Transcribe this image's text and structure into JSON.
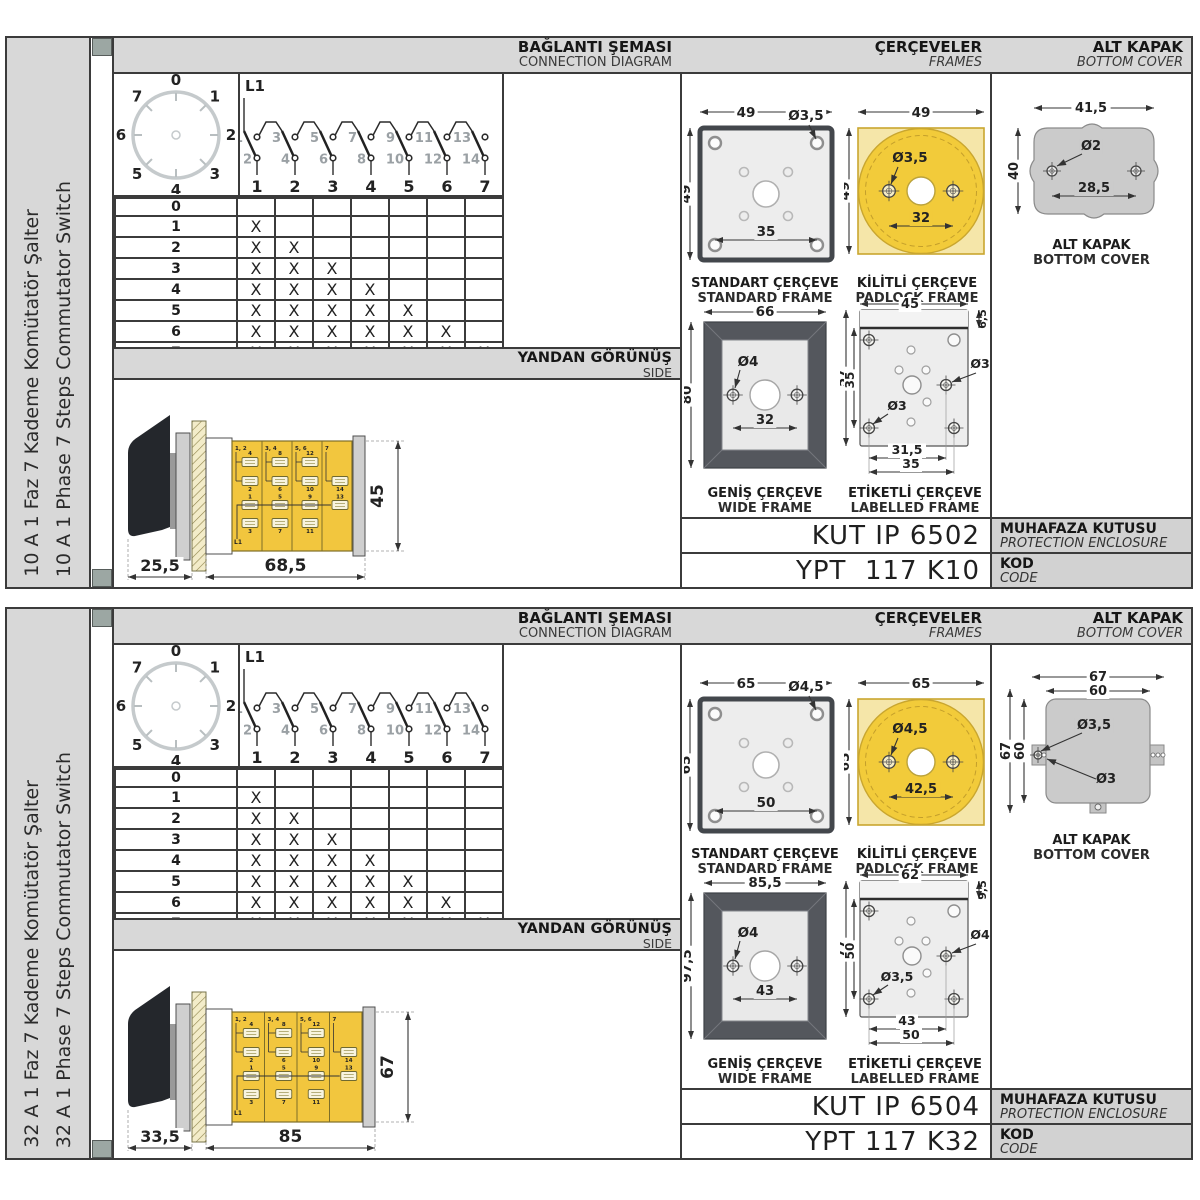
{
  "colors": {
    "border": "#3b3b3b",
    "bar_gray": "#d8d8d8",
    "label_gray": "#d2d2d2",
    "corner_mark": "#9CA7A3",
    "body_yellow": "#F2C63E",
    "padlock_gold": "#F2CB3A",
    "padlock_pale": "#F5E6A9",
    "wide_frame_dark": "#54575D",
    "plate_gray": "#cfcfcf",
    "cover_gray": "#cbcbcb"
  },
  "shared": {
    "dial_labels": [
      "0",
      "1",
      "2",
      "3",
      "4",
      "5",
      "6",
      "7"
    ],
    "l1": {
      "feed": "L1",
      "top": [
        "1",
        "3",
        "5",
        "7",
        "9",
        "11",
        "13"
      ],
      "bottom": [
        "2",
        "4",
        "6",
        "8",
        "10",
        "12",
        "14"
      ],
      "columns": [
        "1",
        "2",
        "3",
        "4",
        "5",
        "6",
        "7"
      ]
    },
    "table": {
      "rows": [
        "0",
        "1",
        "2",
        "3",
        "4",
        "5",
        "6",
        "7"
      ],
      "mark": "X",
      "marks": [
        0,
        1,
        2,
        3,
        4,
        5,
        6,
        7
      ]
    },
    "sideview_labels": {
      "feed": "L1",
      "seg_tops": [
        "1, 2",
        "3, 4",
        "5, 6",
        "7"
      ],
      "upper": [
        [
          "4",
          "2"
        ],
        [
          "8",
          "6"
        ],
        [
          "12",
          "10"
        ],
        [
          "14"
        ]
      ],
      "lower": [
        [
          "1",
          "3"
        ],
        [
          "5",
          "7"
        ],
        [
          "9",
          "11"
        ],
        [
          "13"
        ]
      ]
    }
  },
  "panels": [
    {
      "sidebar_tr": "10 A 1 Faz 7 Kademe Komütatör Şalter",
      "sidebar_en": "10 A 1 Phase 7 Steps Commutator Switch",
      "headers": {
        "connection_tr": "BAĞLANTI ŞEMASI",
        "connection_en": "CONNECTION DIAGRAM",
        "frames_tr": "ÇERÇEVELER",
        "frames_en": "FRAMES",
        "cover_tr": "ALT KAPAK",
        "cover_en": "BOTTOM COVER",
        "side_tr": "YANDAN GÖRÜNÜŞ",
        "side_en": "SIDE"
      },
      "dims": {
        "handle": "25,5",
        "body": "68,5",
        "height": "45"
      },
      "frames": {
        "standard": {
          "caption_tr": "STANDART ÇERÇEVE",
          "caption_en": "STANDARD FRAME",
          "width": "49",
          "height": "49",
          "hole": "Ø3,5",
          "pitch": "35"
        },
        "padlock": {
          "caption_tr": "KİLİTLİ ÇERÇEVE",
          "caption_en": "PADLOCK FRAME",
          "width": "49",
          "height": "49",
          "hole": "Ø3,5",
          "pitch": "32"
        },
        "wide": {
          "caption_tr": "GENİŞ ÇERÇEVE",
          "caption_en": "WIDE FRAME",
          "width": "66",
          "height": "80",
          "hole": "Ø4",
          "pitch": "32"
        },
        "labelled": {
          "caption_tr": "ETİKETLİ ÇERÇEVE",
          "caption_en": "LABELLED FRAME",
          "width": "45",
          "strip": "6,5",
          "height": "57",
          "inner": "35",
          "hole_right": "Ø3",
          "hole_left": "Ø3",
          "pitch1": "31,5",
          "pitch2": "35"
        }
      },
      "cover": {
        "type": "blob",
        "caption_tr": "ALT KAPAK",
        "caption_en": "BOTTOM COVER",
        "width": "41,5",
        "height": "40",
        "hole": "Ø2",
        "pitch": "28,5"
      },
      "codes": {
        "enclosure": "KUT IP 6502",
        "enclosure_label_tr": "MUHAFAZA KUTUSU",
        "enclosure_label_en": "PROTECTION ENCLOSURE",
        "code": "YPT  117 K10",
        "code_label_tr": "KOD",
        "code_label_en": "CODE"
      }
    },
    {
      "sidebar_tr": "32 A 1 Faz 7 Kademe Komütatör Şalter",
      "sidebar_en": "32 A 1 Phase 7 Steps Commutator Switch",
      "headers": {
        "connection_tr": "BAĞLANTI ŞEMASI",
        "connection_en": "CONNECTION DIAGRAM",
        "frames_tr": "ÇERÇEVELER",
        "frames_en": "FRAMES",
        "cover_tr": "ALT KAPAK",
        "cover_en": "BOTTOM COVER",
        "side_tr": "YANDAN GÖRÜNÜŞ",
        "side_en": "SIDE"
      },
      "dims": {
        "handle": "33,5",
        "body": "85",
        "height": "67"
      },
      "frames": {
        "standard": {
          "caption_tr": "STANDART ÇERÇEVE",
          "caption_en": "STANDARD FRAME",
          "width": "65",
          "height": "65",
          "hole": "Ø4,5",
          "pitch": "50"
        },
        "padlock": {
          "caption_tr": "KİLİTLİ ÇERÇEVE",
          "caption_en": "PADLOCK FRAME",
          "width": "65",
          "height": "65",
          "hole": "Ø4,5",
          "pitch": "42,5"
        },
        "wide": {
          "caption_tr": "GENİŞ ÇERÇEVE",
          "caption_en": "WIDE FRAME",
          "width": "85,5",
          "height": "97,5",
          "hole": "Ø4",
          "pitch": "43"
        },
        "labelled": {
          "caption_tr": "ETİKETLİ ÇERÇEVE",
          "caption_en": "LABELLED FRAME",
          "width": "62",
          "strip": "9,5",
          "height": "77",
          "inner": "50",
          "hole_right": "Ø4",
          "hole_left": "Ø3,5",
          "pitch1": "43",
          "pitch2": "50"
        }
      },
      "cover": {
        "type": "tabs",
        "caption_tr": "ALT KAPAK",
        "caption_en": "BOTTOM COVER",
        "w_outer": "67",
        "w_inner": "60",
        "h_outer": "67",
        "h_inner": "60",
        "hole_big": "Ø3,5",
        "hole_small": "Ø3"
      },
      "codes": {
        "enclosure": "KUT IP 6504",
        "enclosure_label_tr": "MUHAFAZA KUTUSU",
        "enclosure_label_en": "PROTECTION ENCLOSURE",
        "code": "YPT 117 K32",
        "code_label_tr": "KOD",
        "code_label_en": "CODE"
      }
    }
  ]
}
